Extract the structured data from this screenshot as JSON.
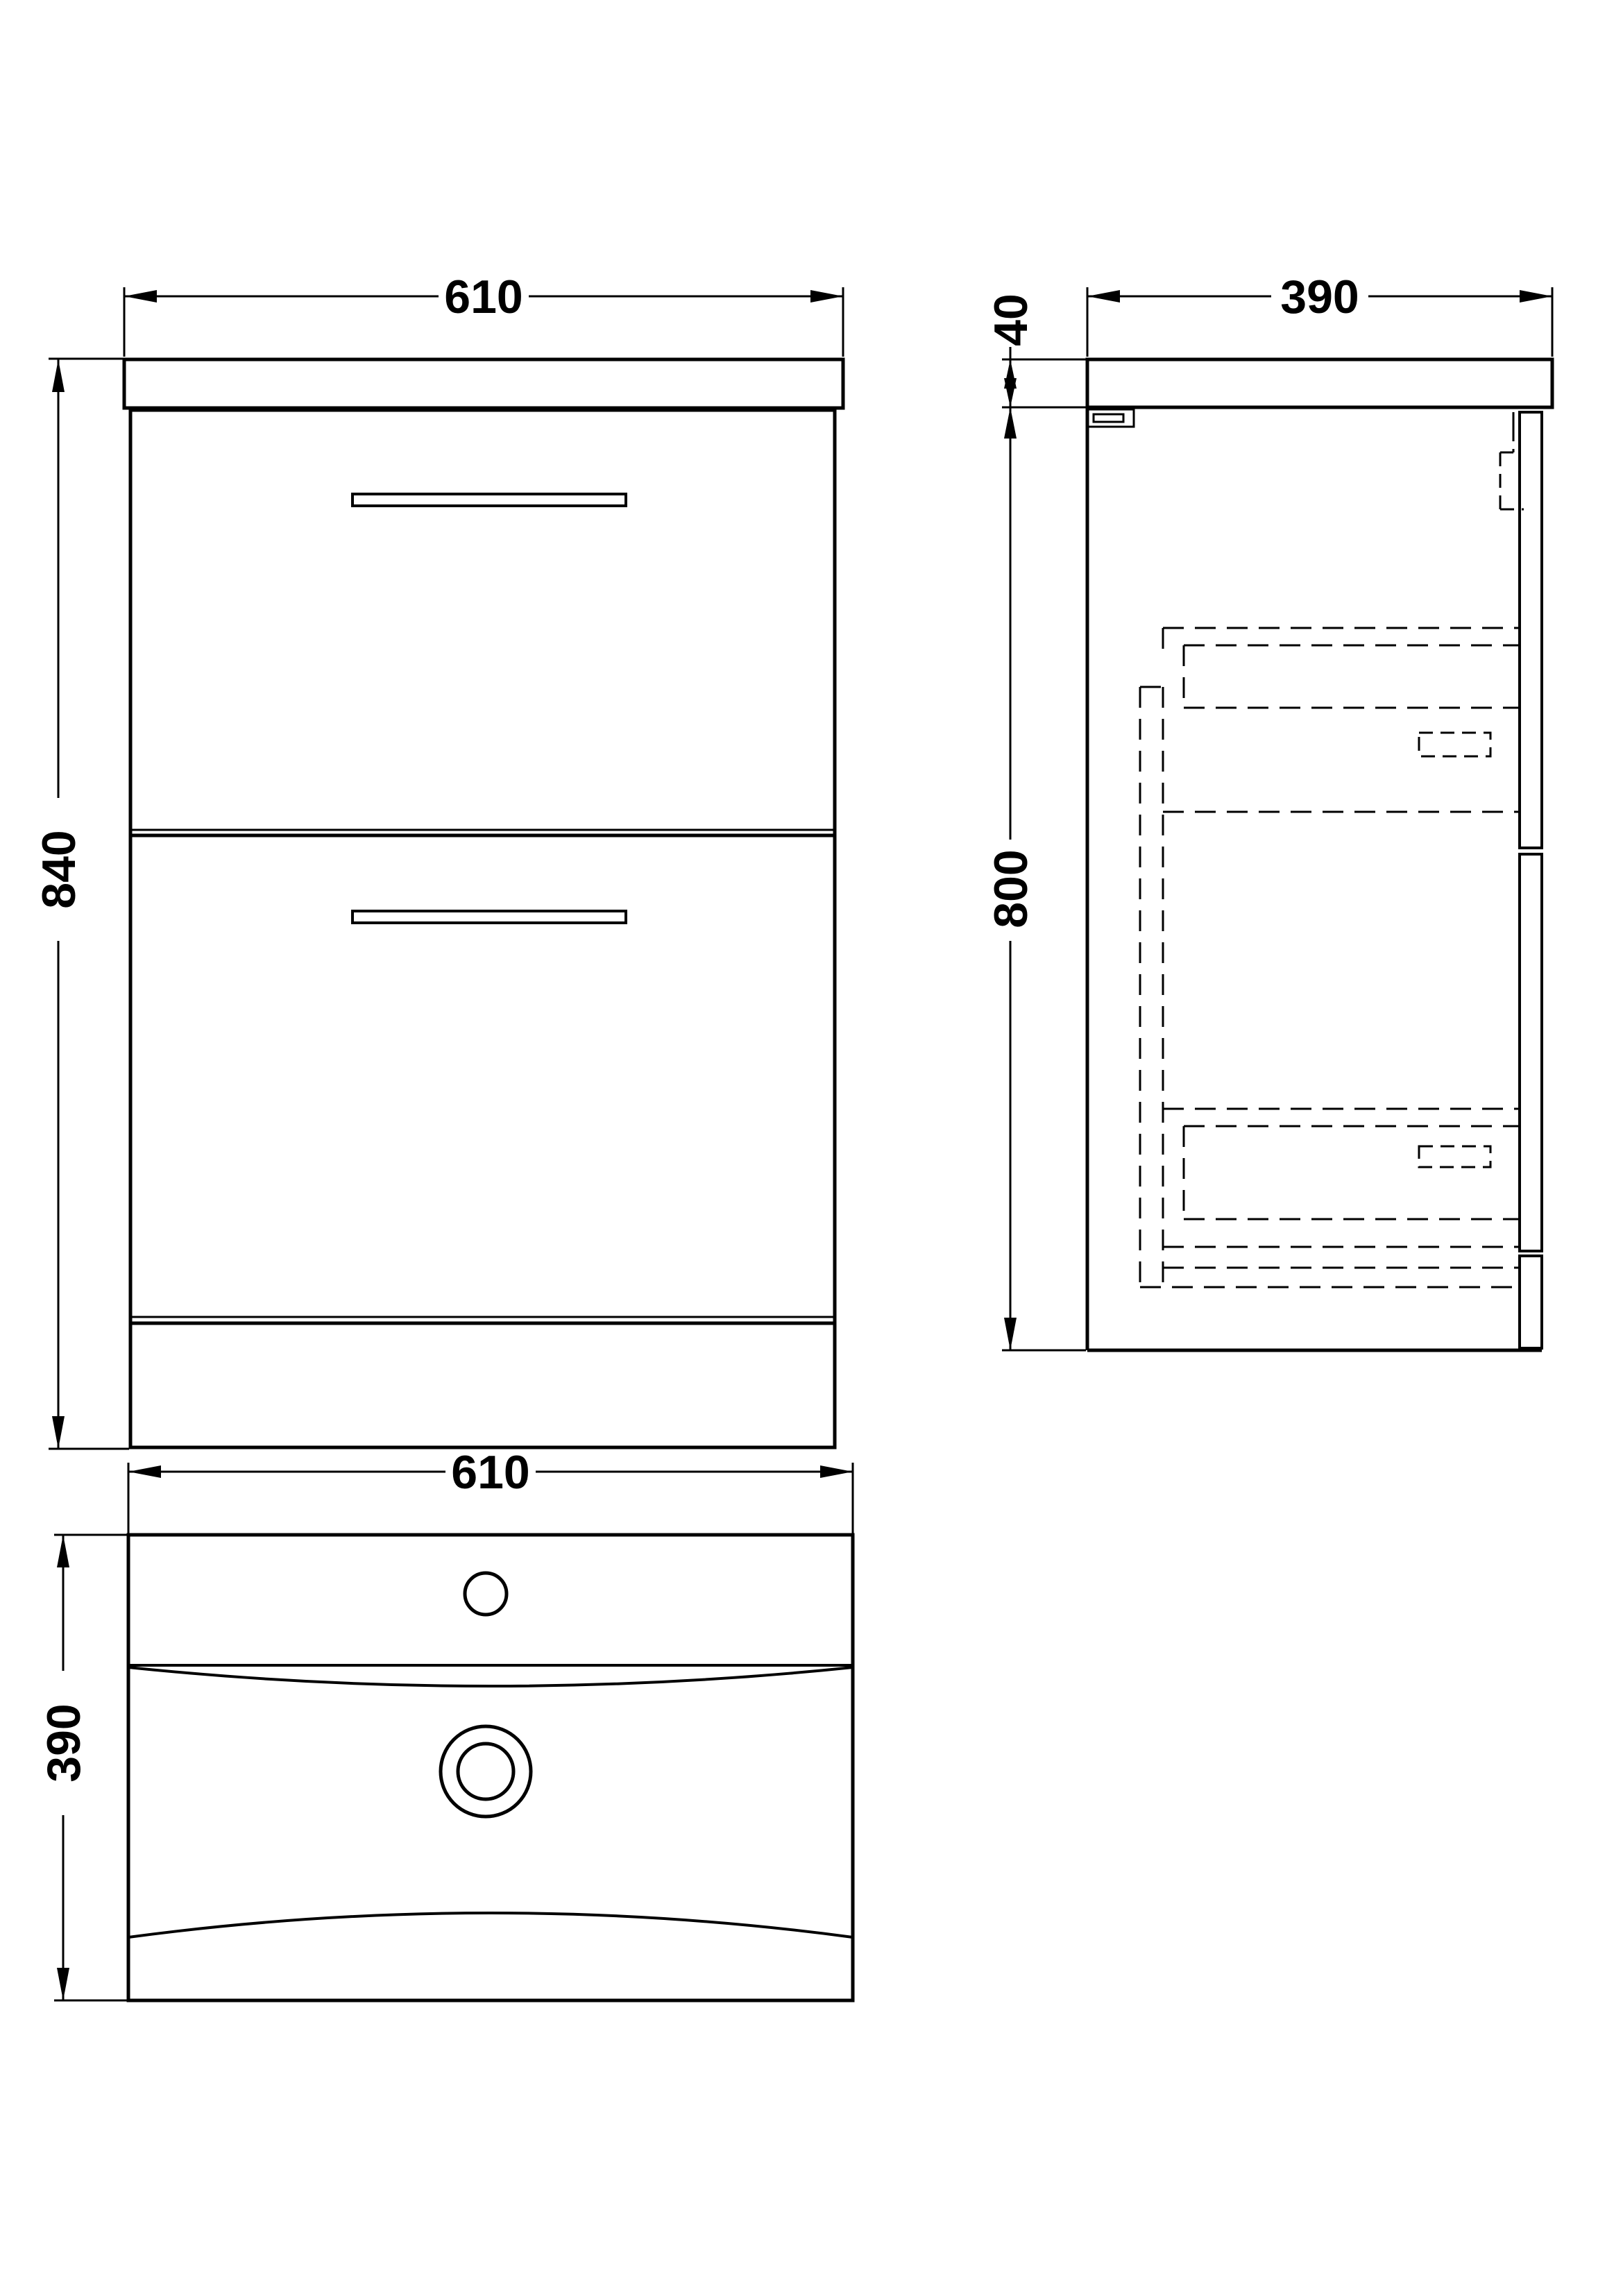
{
  "colors": {
    "background": "#ffffff",
    "line": "#000000"
  },
  "views": {
    "front": {
      "width": "610",
      "height": "840"
    },
    "side": {
      "depth": "390",
      "worktop_thickness": "40",
      "cabinet_height": "800"
    },
    "plan": {
      "width": "610",
      "depth": "390"
    }
  }
}
